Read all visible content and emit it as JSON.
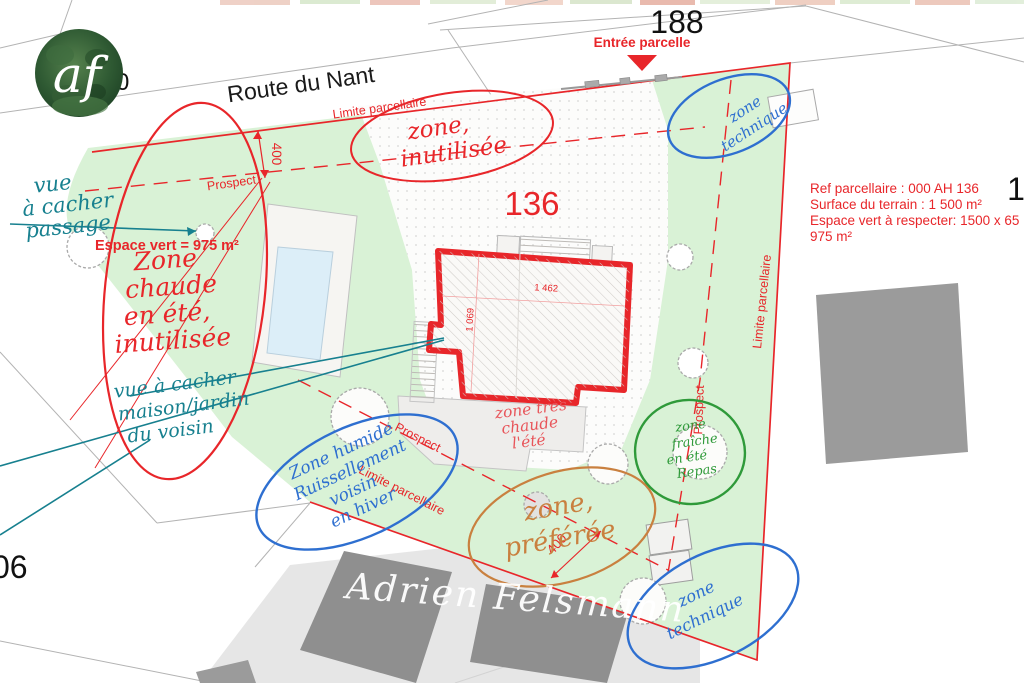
{
  "plan": {
    "street": "Route du Nant",
    "parcels": {
      "main": "136",
      "north": "188",
      "east": "1",
      "southwest": "06"
    },
    "entrance_label": "Entrée parcelle",
    "espace_vert_label": "Espace vert = 975 m²",
    "boundary_label": "Limite parcellaire",
    "prospect_label": "Prospect",
    "info": {
      "ref": "Ref parcellaire : 000 AH 136",
      "surface": "Surface du terrain : 1 500 m²",
      "espace_vert": "Espace vert à respecter:  1500 x 65",
      "espace_vert_2": "975 m²"
    },
    "dimensions": {
      "setback_front": "400",
      "setback_rear": "400",
      "building_length": "1 462",
      "building_width": "1 069"
    }
  },
  "annotations": {
    "zone_inutilisee": {
      "color": "#e8262a",
      "lines": [
        "zone,",
        "inutilisée"
      ]
    },
    "zone_chaude": {
      "color": "#e8262a",
      "lines": [
        "Zone",
        "chaude",
        "en été,",
        "inutilisée"
      ]
    },
    "zone_tres_chaude": {
      "color": "#e8262a",
      "lines": [
        "zone très",
        "chaude",
        "l'été"
      ]
    },
    "zone_technique_nord": {
      "color": "#2e6fd0",
      "lines": [
        "zone",
        "technique"
      ]
    },
    "zone_technique_sud": {
      "color": "#2e6fd0",
      "lines": [
        "zone",
        "technique"
      ]
    },
    "zone_humide": {
      "color": "#2e6fd0",
      "lines": [
        "Zone humide",
        "Ruissellement",
        "voisin",
        "en hiver"
      ]
    },
    "zone_preferee": {
      "color": "#c9803f",
      "lines": [
        "zone,",
        "préférée"
      ]
    },
    "zone_fraiche": {
      "color": "#2f9a3a",
      "lines": [
        "zone",
        "fraîche",
        "en été",
        "Repas"
      ]
    },
    "vue_passage": {
      "color": "#17808f",
      "lines": [
        "vue",
        "à cacher",
        "passage"
      ]
    },
    "vue_voisin": {
      "color": "#17808f",
      "lines": [
        "vue à cacher",
        "maison/jardin",
        "du voisin"
      ]
    }
  },
  "branding": {
    "signature": "Adrien Felsmann",
    "logo_initials": "af",
    "masked_digit": "0"
  },
  "colors": {
    "parcel_green": "#d9f2d6",
    "boundary_red": "#e8262a",
    "hand_blue": "#2e6fd0",
    "hand_teal": "#17808f",
    "hand_green": "#2f9a3a",
    "hand_orange": "#c9803f",
    "pool_blue": "#dceef8",
    "neighbor_gray": "#909090"
  }
}
